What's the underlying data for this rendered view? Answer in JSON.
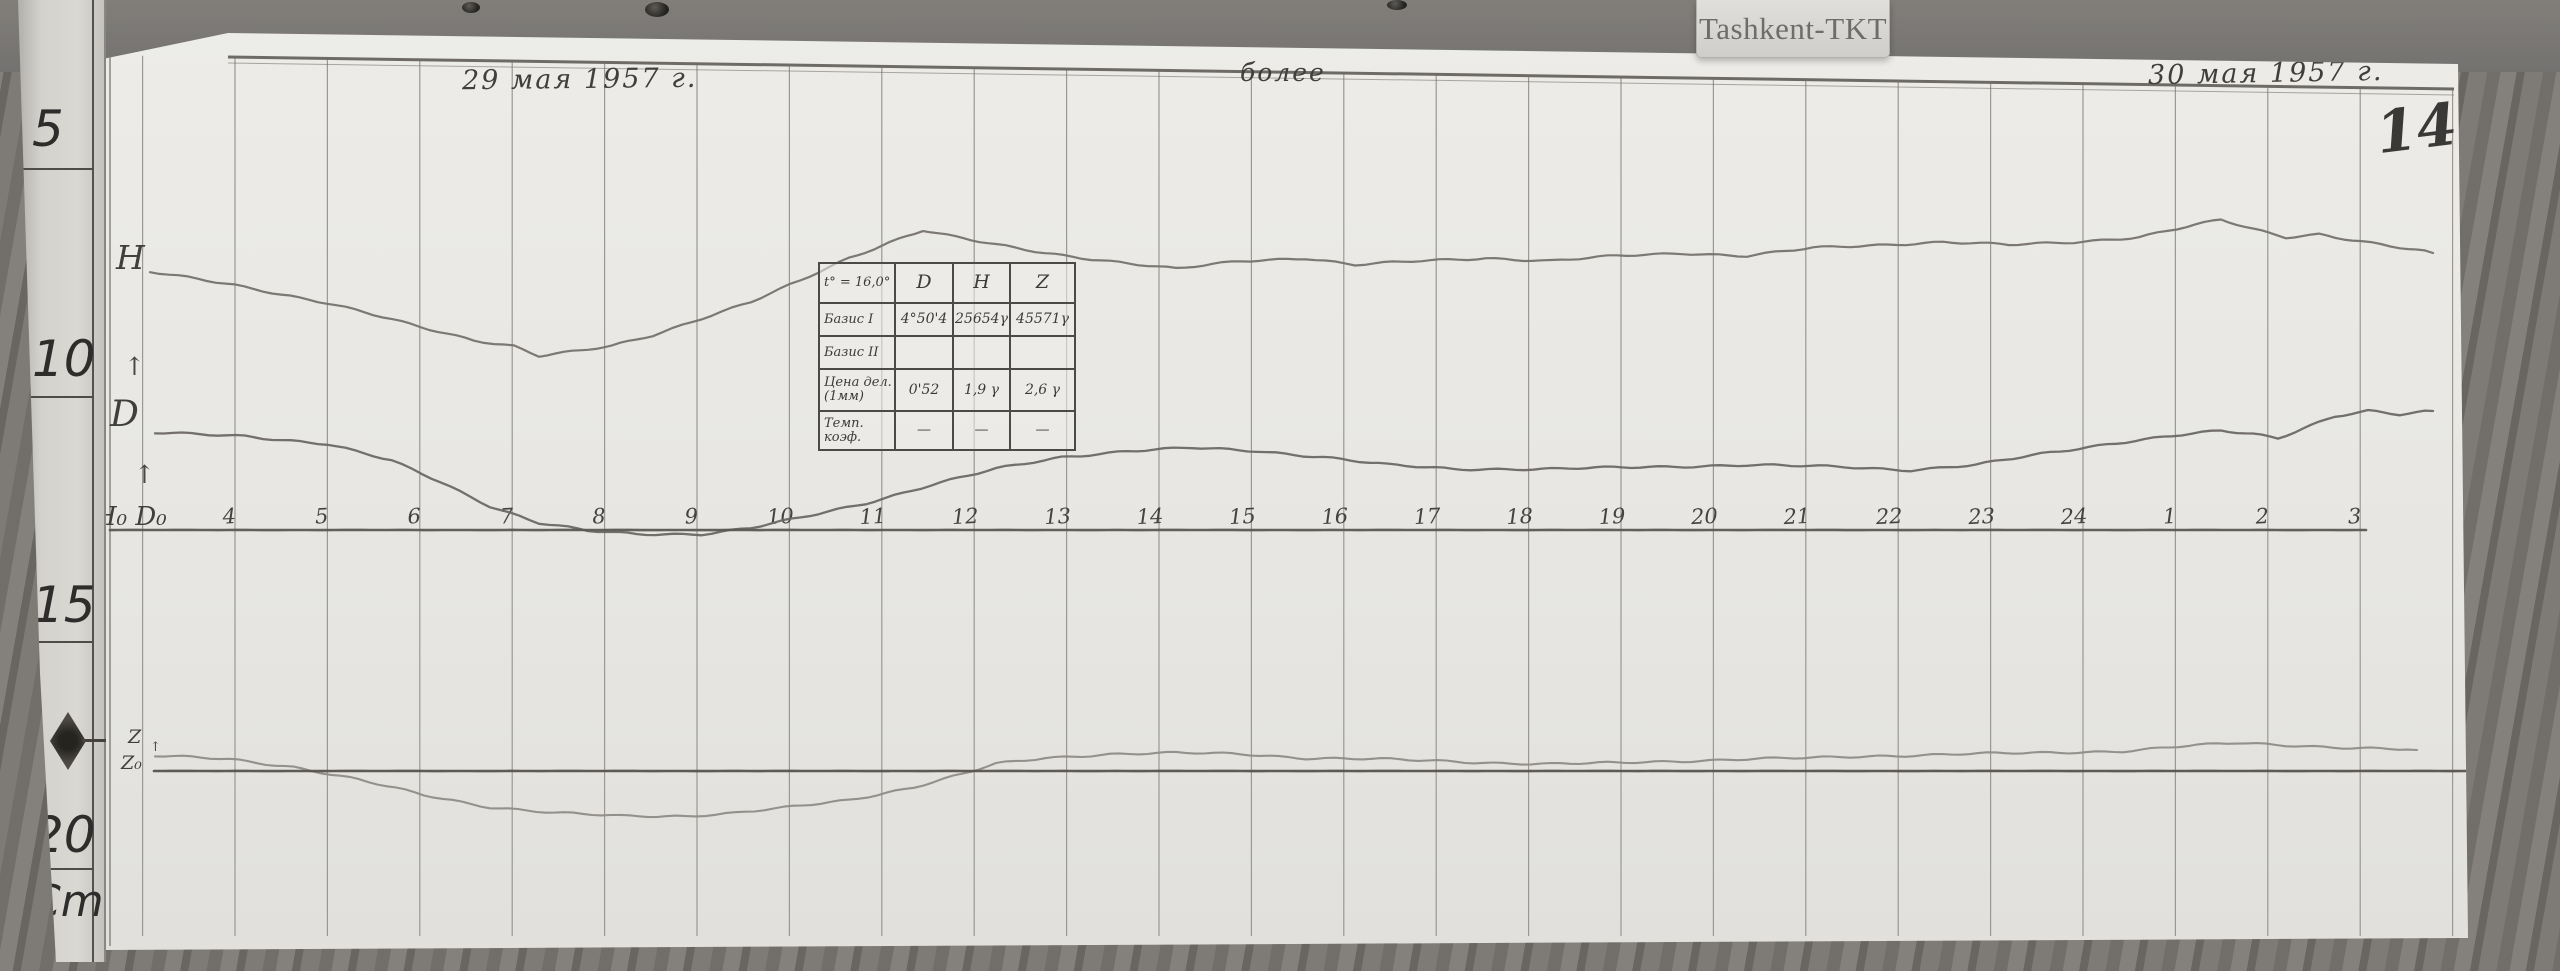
{
  "station_label": "Tashkent-TKT",
  "page_number": "149",
  "header_notes": {
    "date_left": "29 мая 1957 г.",
    "center_note": "более",
    "date_right": "30 мая 1957 г."
  },
  "ruler": {
    "marks": [
      "5",
      "10",
      "15",
      "20"
    ],
    "unit": "Cm"
  },
  "trace_labels": {
    "h": "Н",
    "d": "D",
    "z": "Z",
    "z0": "Z₀",
    "axis_origin": "Н₀ D₀",
    "arrow_up": "↑"
  },
  "baseline_table": {
    "header": [
      "t° = 16,0°",
      "D",
      "Н",
      "Z"
    ],
    "rows": [
      [
        "Базис I",
        "4°50'4",
        "25654γ",
        "45571γ"
      ],
      [
        "Базис II",
        "",
        "",
        ""
      ],
      [
        "Цена дел. (1мм)",
        "0'52",
        "1,9 γ",
        "2,6 γ"
      ],
      [
        "Темп. коэф.",
        "—",
        "—",
        "—"
      ]
    ]
  },
  "chart_data": {
    "type": "line",
    "title": "Magnetogram, Tashkent-TKT observatory, 29–30 мая 1957 г., sheet 149",
    "xlabel": "time, hours (local)",
    "ylabel": "deflection (no numeric scale printed; cm ruler at left edge)",
    "x_tick_labels": [
      "4",
      "5",
      "6",
      "7",
      "8",
      "9",
      "10",
      "11",
      "12",
      "13",
      "14",
      "15",
      "16",
      "17",
      "18",
      "19",
      "20",
      "21",
      "22",
      "23",
      "24",
      "1",
      "2",
      "3"
    ],
    "x_tick_start_px": 145,
    "x_tick_step_px": 92.4,
    "legend_position": "labels handwritten at left ends of traces",
    "grid": "vertical hour lines only",
    "series": [
      {
        "name": "H",
        "style": "wiggly pencil trace",
        "points_px": [
          [
            60,
            272
          ],
          [
            145,
            285
          ],
          [
            237,
            303
          ],
          [
            330,
            327
          ],
          [
            384,
            340
          ],
          [
            424,
            346
          ],
          [
            449,
            356
          ],
          [
            490,
            351
          ],
          [
            522,
            346
          ],
          [
            563,
            335
          ],
          [
            612,
            318
          ],
          [
            661,
            302
          ],
          [
            710,
            281
          ],
          [
            759,
            258
          ],
          [
            800,
            242
          ],
          [
            833,
            230
          ],
          [
            865,
            237
          ],
          [
            906,
            245
          ],
          [
            955,
            253
          ],
          [
            1020,
            261
          ],
          [
            1086,
            269
          ],
          [
            1151,
            261
          ],
          [
            1216,
            258
          ],
          [
            1265,
            265
          ],
          [
            1331,
            261
          ],
          [
            1396,
            258
          ],
          [
            1461,
            261
          ],
          [
            1527,
            256
          ],
          [
            1592,
            253
          ],
          [
            1657,
            256
          ],
          [
            1723,
            248
          ],
          [
            1788,
            245
          ],
          [
            1853,
            242
          ],
          [
            1919,
            245
          ],
          [
            1984,
            242
          ],
          [
            2049,
            237
          ],
          [
            2106,
            225
          ],
          [
            2131,
            220
          ],
          [
            2163,
            229
          ],
          [
            2196,
            237
          ],
          [
            2229,
            234
          ],
          [
            2262,
            240
          ],
          [
            2310,
            248
          ],
          [
            2343,
            253
          ]
        ]
      },
      {
        "name": "D",
        "style": "wiggly pencil trace",
        "points_px": [
          [
            65,
            433
          ],
          [
            155,
            436
          ],
          [
            237,
            444
          ],
          [
            302,
            461
          ],
          [
            351,
            482
          ],
          [
            400,
            506
          ],
          [
            449,
            523
          ],
          [
            498,
            531
          ],
          [
            547,
            534
          ],
          [
            612,
            534
          ],
          [
            661,
            528
          ],
          [
            710,
            518
          ],
          [
            776,
            503
          ],
          [
            841,
            485
          ],
          [
            906,
            469
          ],
          [
            972,
            457
          ],
          [
            1037,
            451
          ],
          [
            1102,
            448
          ],
          [
            1167,
            451
          ],
          [
            1233,
            457
          ],
          [
            1298,
            465
          ],
          [
            1363,
            469
          ],
          [
            1461,
            469
          ],
          [
            1559,
            467
          ],
          [
            1657,
            465
          ],
          [
            1755,
            467
          ],
          [
            1821,
            470
          ],
          [
            1886,
            465
          ],
          [
            1951,
            454
          ],
          [
            2017,
            444
          ],
          [
            2082,
            436
          ],
          [
            2131,
            431
          ],
          [
            2163,
            434
          ],
          [
            2188,
            438
          ],
          [
            2213,
            428
          ],
          [
            2245,
            416
          ],
          [
            2278,
            411
          ],
          [
            2310,
            415
          ],
          [
            2343,
            411
          ]
        ]
      },
      {
        "name": "Z",
        "style": "wiggly pencil trace",
        "points_px": [
          [
            65,
            756
          ],
          [
            139,
            759
          ],
          [
            204,
            767
          ],
          [
            269,
            780
          ],
          [
            334,
            795
          ],
          [
            400,
            807
          ],
          [
            465,
            813
          ],
          [
            530,
            816
          ],
          [
            596,
            816
          ],
          [
            645,
            813
          ],
          [
            694,
            808
          ],
          [
            759,
            800
          ],
          [
            824,
            787
          ],
          [
            873,
            774
          ],
          [
            906,
            764
          ],
          [
            955,
            758
          ],
          [
            1020,
            754
          ],
          [
            1086,
            753
          ],
          [
            1151,
            754
          ],
          [
            1216,
            758
          ],
          [
            1282,
            759
          ],
          [
            1347,
            761
          ],
          [
            1412,
            763
          ],
          [
            1461,
            764
          ],
          [
            1527,
            763
          ],
          [
            1592,
            761
          ],
          [
            1657,
            759
          ],
          [
            1723,
            758
          ],
          [
            1788,
            756
          ],
          [
            1870,
            754
          ],
          [
            1951,
            753
          ],
          [
            2033,
            751
          ],
          [
            2098,
            746
          ],
          [
            2147,
            743
          ],
          [
            2196,
            745
          ],
          [
            2262,
            748
          ],
          [
            2327,
            750
          ]
        ]
      },
      {
        "name": "Z0-baseline",
        "style": "straight ruled line",
        "points_px": [
          [
            64,
            771
          ],
          [
            2420,
            771
          ]
        ]
      },
      {
        "name": "H0D0-axis",
        "style": "straight ruled line with hour ticks",
        "points_px": [
          [
            20,
            530
          ],
          [
            2276,
            530
          ]
        ]
      }
    ]
  }
}
